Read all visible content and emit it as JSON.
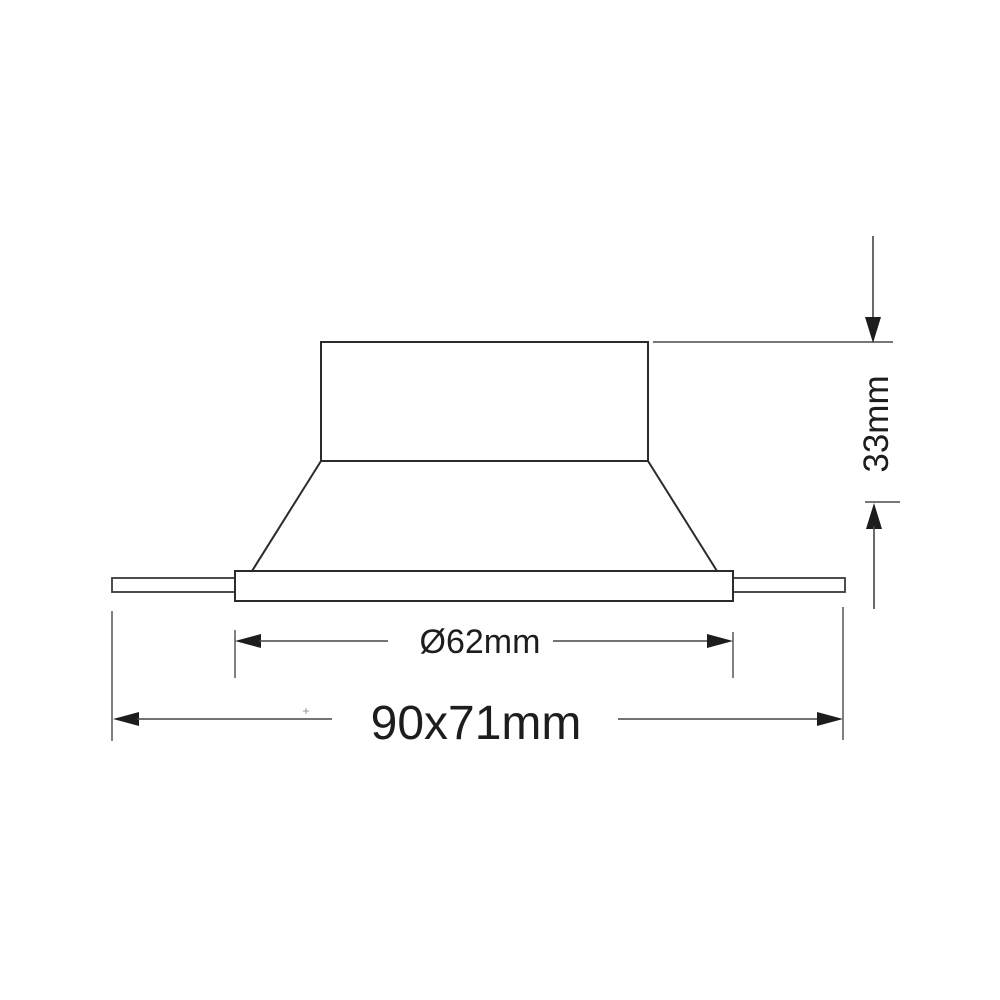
{
  "page": {
    "background_color": "#ffffff"
  },
  "drawing": {
    "kind": "technical dimension drawing",
    "subject": "recessed downlight fixture, side profile view",
    "outline_color": "#2b2b2b",
    "dimension_line_color": "#454545",
    "text_color": "#1d1d1d",
    "dimensions": {
      "recess_depth": {
        "label": "33mm",
        "orientation": "vertical-right"
      },
      "cutout_diameter": {
        "label": "Ø62mm",
        "orientation": "horizontal"
      },
      "overall_size": {
        "label": "90x71mm",
        "orientation": "horizontal"
      }
    }
  }
}
